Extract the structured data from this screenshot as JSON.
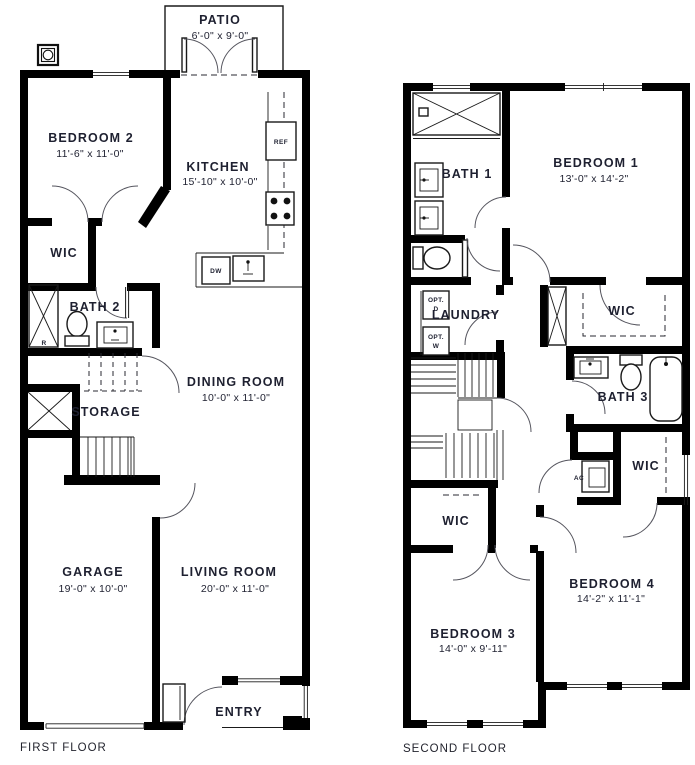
{
  "colors": {
    "wall": "#000000",
    "line": "#1a1a1a",
    "text": "#1e2030",
    "background": "#ffffff"
  },
  "first_floor": {
    "caption": "FIRST FLOOR",
    "patio": {
      "name": "PATIO",
      "dims": "6'-0\" x 9'-0\""
    },
    "bedroom2": {
      "name": "BEDROOM 2",
      "dims": "11'-6\" x 11'-0\""
    },
    "kitchen": {
      "name": "KITCHEN",
      "dims": "15'-10\" x 10'-0\""
    },
    "wic": {
      "name": "WIC"
    },
    "bath2": {
      "name": "BATH 2",
      "shower_mark": "R"
    },
    "dining": {
      "name": "DINING ROOM",
      "dims": "10'-0\" x 11'-0\""
    },
    "storage": {
      "name": "STORAGE"
    },
    "garage": {
      "name": "GARAGE",
      "dims": "19'-0\" x 10'-0\""
    },
    "living": {
      "name": "LIVING ROOM",
      "dims": "20'-0\" x 11'-0\""
    },
    "entry": {
      "name": "ENTRY"
    },
    "appliances": {
      "ref": "REF",
      "dw": "DW"
    }
  },
  "second_floor": {
    "caption": "SECOND FLOOR",
    "bath1": {
      "name": "BATH 1"
    },
    "bedroom1": {
      "name": "BEDROOM 1",
      "dims": "13'-0\" x 14'-2\""
    },
    "laundry": {
      "name": "LAUNDRY",
      "opt_dryer": [
        "OPT.",
        "D"
      ],
      "opt_washer": [
        "OPT.",
        "W"
      ]
    },
    "wic_bed1": {
      "name": "WIC"
    },
    "bath3": {
      "name": "BATH 3"
    },
    "ac": {
      "name": "AC"
    },
    "wic_bed4": {
      "name": "WIC"
    },
    "wic_bed3": {
      "name": "WIC"
    },
    "bedroom3": {
      "name": "BEDROOM 3",
      "dims": "14'-0\" x 9'-11\""
    },
    "bedroom4": {
      "name": "BEDROOM 4",
      "dims": "14'-2\" x 11'-1\""
    }
  }
}
